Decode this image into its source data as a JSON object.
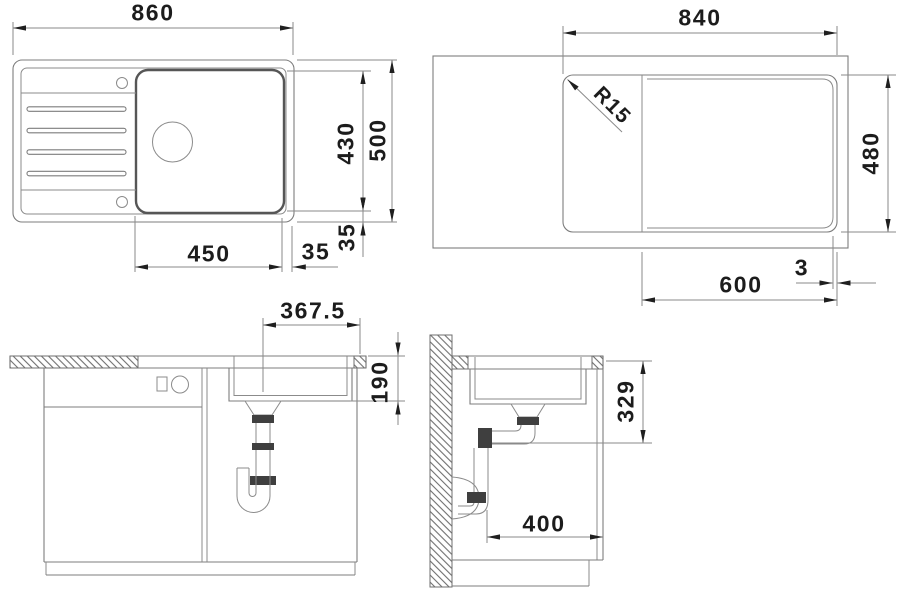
{
  "drawing": {
    "type": "technical-drawing",
    "subject": "Inset kitchen sink with drainboard - installation dimension views",
    "units": "mm"
  },
  "dims": {
    "top_view": {
      "overall_width": "860",
      "overall_depth": "500",
      "bowl_depth": "430",
      "bowl_width": "450",
      "bowl_offset_right": "35",
      "bowl_offset_bottom": "35"
    },
    "cutout_view": {
      "cutout_width": "840",
      "cutout_depth": "480",
      "corner_radius": "R15",
      "bowl_zone_width": "600",
      "edge_gap": "3"
    },
    "front_view": {
      "drain_to_edge": "367.5",
      "bowl_inner_depth": "190"
    },
    "side_view": {
      "outlet_height": "329",
      "outlet_to_front": "400"
    }
  },
  "colors": {
    "background": "#ffffff",
    "object_line": "#7d7d7d",
    "bold_line": "#565656",
    "dim_line": "#8a8a8a",
    "text": "#1c1c1c",
    "fitting_fill": "#3f3f3f"
  }
}
